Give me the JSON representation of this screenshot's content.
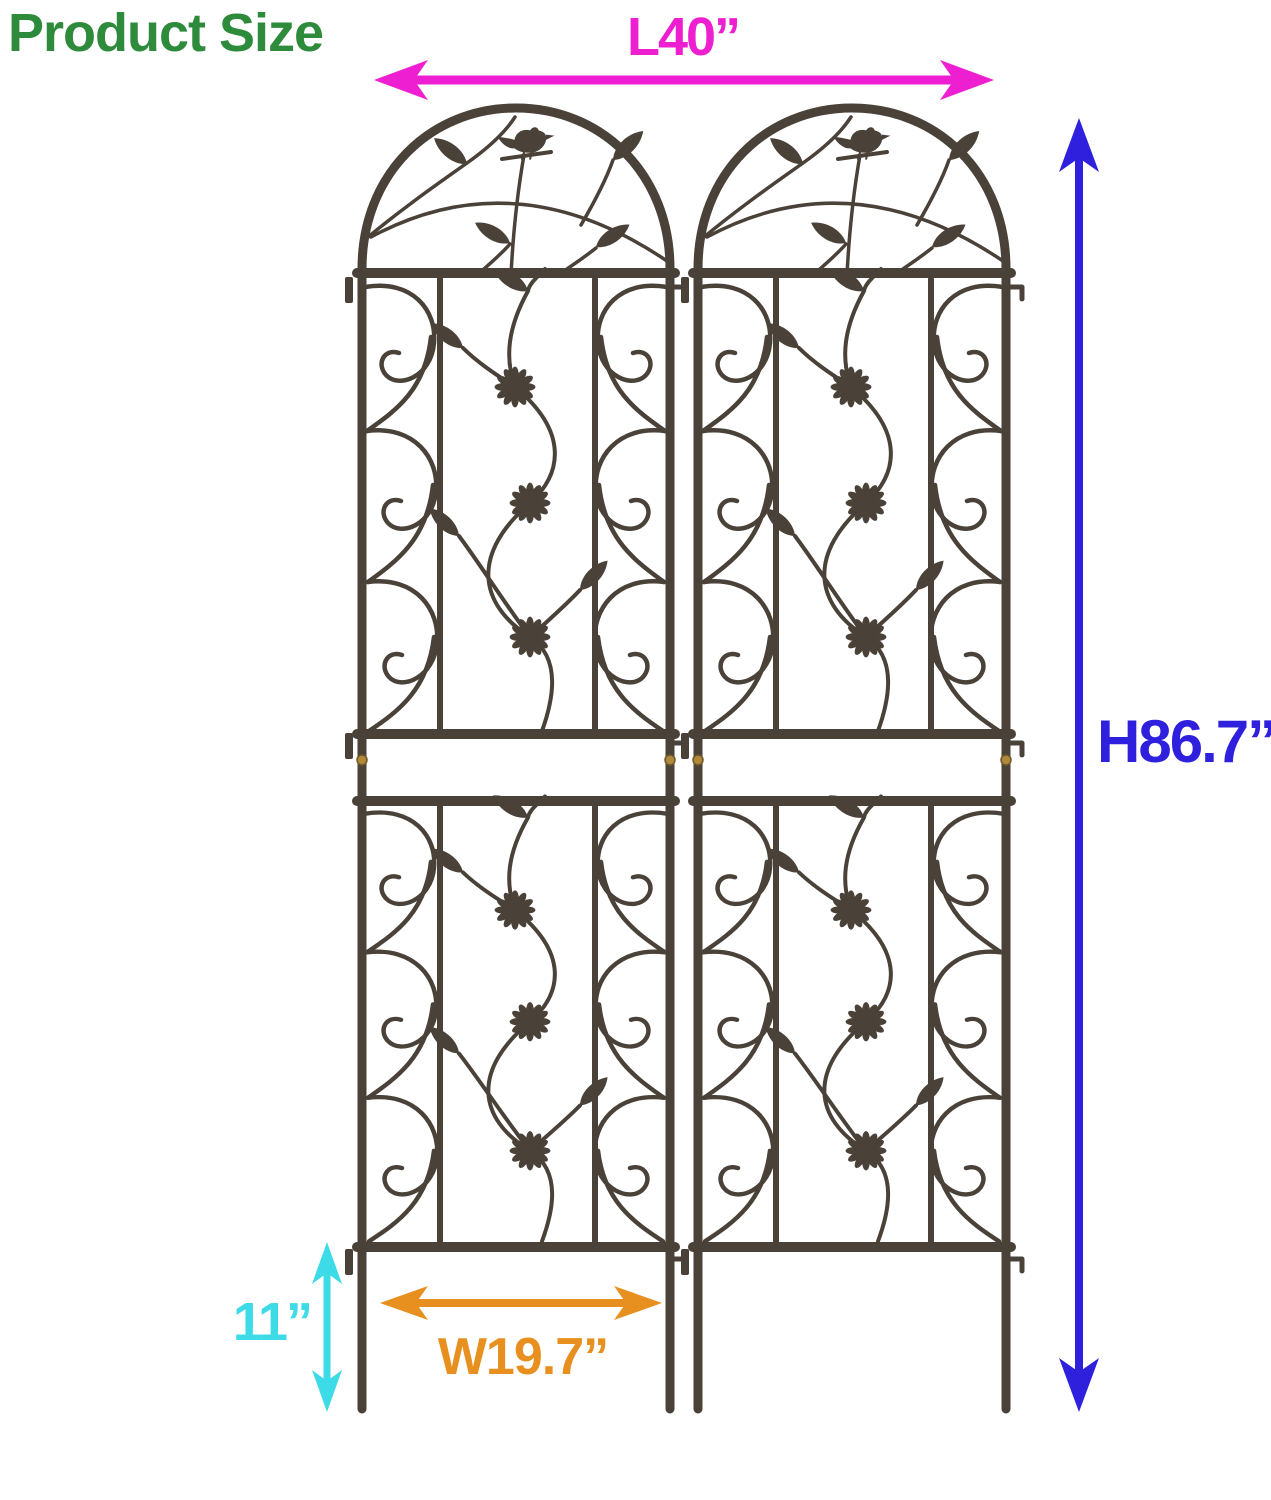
{
  "title": {
    "text": "Product Size",
    "color": "#2e8b3c"
  },
  "illustration": {
    "panel_count": 2,
    "metal_color": "#4a4138",
    "screw_color": "#b1893a",
    "motifs": [
      "arched top",
      "bird",
      "leaves",
      "daisy flowers",
      "scrollwork"
    ]
  },
  "dimensions": {
    "length": {
      "label": "L40”",
      "color": "#ee1fd0"
    },
    "height": {
      "label": "H86.7”",
      "color": "#2e20dd"
    },
    "stake_height": {
      "label": "11”",
      "color": "#3ddbe8"
    },
    "panel_width": {
      "label": "W19.7”",
      "color": "#e8901f"
    }
  }
}
